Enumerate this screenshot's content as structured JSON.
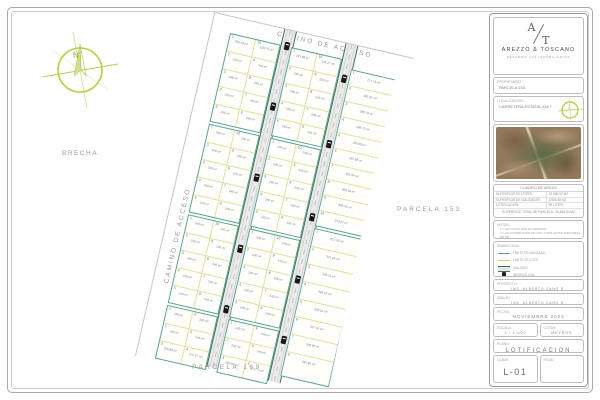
{
  "compass": {
    "north_letter": "N"
  },
  "colors": {
    "block_border": "#5ba193",
    "lot_line": "#dde2a0",
    "road_edge": "#3f7354",
    "compass_green": "#b5d04b"
  },
  "plat": {
    "road_label_top": "CAMINO DE ACCESO",
    "road_label_left": "CAMINO DE ACCESO",
    "label_brecha": "BRECHA",
    "label_parcela_right": "PARCELA 153",
    "label_parcela_bottom": "PARCELA 169",
    "unit": "m²",
    "left_block": {
      "sub_blocks": [
        {
          "rows": [
            [
              "1|255.13",
              "10|229.75"
            ],
            [
              "2|240",
              "9|240"
            ],
            [
              "3|240",
              "8|240"
            ],
            [
              "4|240",
              "7|240"
            ],
            [
              "5|240",
              "6|240"
            ]
          ]
        },
        {
          "rows": [
            [
              "1|240",
              "10|240"
            ],
            [
              "2|240",
              "9|240"
            ],
            [
              "3|240",
              "8|240"
            ],
            [
              "4|240",
              "7|240"
            ],
            [
              "5|240",
              "6|240"
            ]
          ]
        },
        {
          "rows": [
            [
              "1|240",
              "10|240"
            ],
            [
              "2|240",
              "9|240"
            ],
            [
              "3|240",
              "8|240"
            ],
            [
              "4|240",
              "7|240"
            ],
            [
              "5|240",
              "6|240"
            ]
          ]
        },
        {
          "rows": [
            [
              "1|240",
              "6|240"
            ],
            [
              "2|240",
              "5|240"
            ],
            [
              "3|250.85",
              "4|272.57"
            ]
          ]
        }
      ]
    },
    "middle_block": {
      "sub_blocks": [
        {
          "rows": [
            [
              "1|243.69",
              "10|218.27"
            ],
            [
              "2|240",
              "9|240"
            ],
            [
              "3|240",
              "8|240"
            ],
            [
              "4|240",
              "7|240"
            ],
            [
              "5|240",
              "6|240"
            ]
          ]
        },
        {
          "rows": [
            [
              "1|240",
              "10|240"
            ],
            [
              "2|240",
              "9|240"
            ],
            [
              "3|240",
              "8|240"
            ],
            [
              "4|240",
              "7|240"
            ],
            [
              "5|240",
              "6|240"
            ]
          ]
        },
        {
          "rows": [
            [
              "1|240",
              "10|240"
            ],
            [
              "2|240",
              "9|240"
            ],
            [
              "3|240",
              "8|240"
            ],
            [
              "4|240",
              "7|240"
            ],
            [
              "5|240",
              "6|240"
            ]
          ]
        },
        {
          "rows": [
            [
              "1|240",
              "6|240"
            ],
            [
              "2|240",
              "5|240"
            ],
            [
              "3|253.02",
              "4|274.74"
            ]
          ]
        }
      ]
    },
    "right_block": {
      "sub_blocks": [
        {
          "lots": [
            "1|271.75",
            "2|281.81",
            "3|285.76",
            "4|289.70",
            "5|293.65",
            "6|297.59",
            "7|301.54",
            "8|305.48",
            "9|309.43",
            "10|313.37"
          ]
        },
        {
          "lots": [
            "1|317.32",
            "2|321.26",
            "3|325.21",
            "4|329.15",
            "5|333.10",
            "6|337.04",
            "7|340.99",
            "8|367.85"
          ]
        }
      ]
    },
    "cars_road1": [
      12,
      74,
      147,
      220,
      282
    ],
    "cars_road2": [
      31,
      98,
      173,
      237,
      299
    ]
  },
  "titleblock": {
    "logo": {
      "monogram_top": "A",
      "monogram_bottom": "T",
      "company": "AREZZO & TOSCANO",
      "tagline": "DESARROLLOS INMOBILIARIOS"
    },
    "field1": {
      "label": "PROPIETARIO:",
      "value": "PARCELA 153"
    },
    "field2": {
      "label": "LOCALIZACION:",
      "value": "CARRETERA ESTATAL KM 7"
    },
    "areas": {
      "title": "CUADRO DE AREAS",
      "rows": [
        [
          "SUPERFICIE DE LOTES",
          "22,980.02 M2"
        ],
        [
          "SUPERFICIE DE VIALIDADES",
          "3,656.48 M2"
        ],
        [
          "LOTIFICACION",
          "90 LOTES"
        ]
      ],
      "total": "SUPERFICIE TOTAL DE PARCELA : 26,636.50 M2"
    },
    "notas": {
      "title": "NOTAS:",
      "lines": [
        "1. LAS COTAS SON EN METROS.",
        "2. LAS SUPERFICIES DE LOS LOTES ESTAN INDICADAS EN M2."
      ]
    },
    "simbologia": {
      "title": "SIMBOLOGIA:",
      "items": [
        {
          "icon": "line-teal",
          "label": "LIMITE DE MANZANA"
        },
        {
          "icon": "line-olive",
          "label": "LIMITE DE LOTE"
        },
        {
          "icon": "road",
          "label": "VIALIDAD"
        },
        {
          "icon": "car",
          "label": "SENTIDO VIAL"
        }
      ]
    },
    "proyecto": {
      "label": "PROYECTO:",
      "value": "ING. ALBERTO CANO R."
    },
    "dibujo": {
      "label": "DIBUJO:",
      "value": "ING. ALBERTO CANO R."
    },
    "fecha": {
      "label": "FECHA:",
      "value": "NOVIEMBRE 2023"
    },
    "escala": {
      "label": "ESCALA:",
      "value": "1 : 1,000"
    },
    "cotas": {
      "label": "COTAS:",
      "value": "METROS"
    },
    "plano": {
      "label": "PLANO:",
      "value": "LOTIFICACION"
    },
    "clave": {
      "label": "CLAVE:",
      "value": "L-01"
    },
    "hoja": {
      "label": "HOJA:",
      "value": ""
    }
  }
}
